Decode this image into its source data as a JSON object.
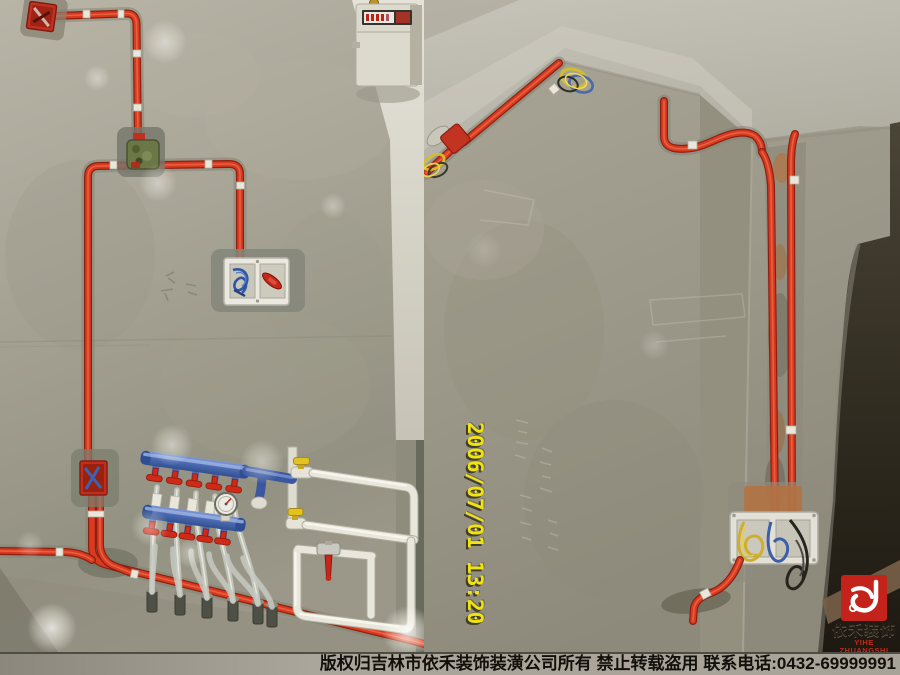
{
  "caption": {
    "text": "版权归吉林市依禾装饰装潢公司所有 禁止转载盗用 联系电话:0432-69999991"
  },
  "timestamp": {
    "text": "2006/07/01 13:20",
    "color": "#f0e40c"
  },
  "watermark": {
    "name_cn": "依禾装饰",
    "name_en": "YIHE ZHUANGSHI",
    "brand_color": "#c22a1c"
  },
  "colors": {
    "conduit_red": "#d8391f",
    "manifold_blue": "#4a68b0",
    "valve_yellow": "#e2c21e",
    "wall_gray": "#a5a295",
    "caption_bg": "#a8a399"
  }
}
